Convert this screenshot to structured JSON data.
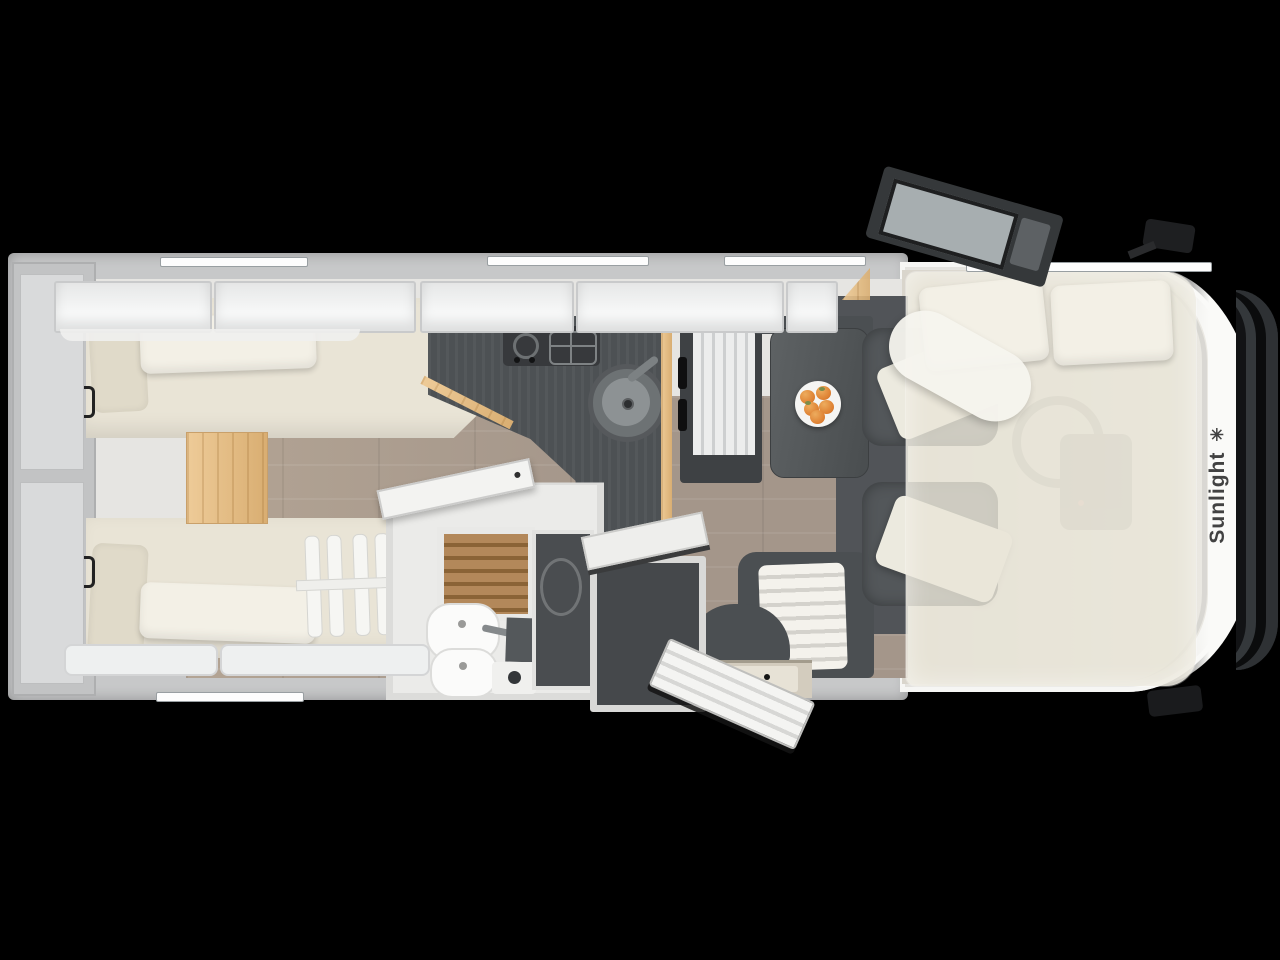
{
  "scene": {
    "type": "motorhome-floorplan-top-view",
    "description": "Top-down cutaway floor plan render of a Sunlight motorhome on a black background",
    "background_color": "#000000"
  },
  "branding": {
    "logo_text": "Sunlight",
    "logo_star_icon": "✳"
  },
  "palette": {
    "wall": "#c7c8c9",
    "cabinet_white": "#f3f4f4",
    "mattress_cream": "#e9e4d6",
    "pillow": "#f3f0e6",
    "floor_wood": "#a4968a",
    "oak_wood": "#e2bd8d",
    "counter_dark": "#4d5154",
    "seat_dark": "#53575a",
    "teak_slats": "#a97f4f",
    "fruit_orange": "#e0893c",
    "grille_black": "#121315",
    "drop_down_bed_overlay": "rgba(233,229,216,0.82)"
  },
  "zones": [
    "rear twin single beds with pillows and bed ladder",
    "oak step cabinet between beds",
    "rear garage storage",
    "kitchen with two-burner hob and round sink",
    "fridge with two black handles",
    "bathroom with teak shower grate and washbasin",
    "dark wardrobes",
    "dinette table with fruit plate and striped bench",
    "open entry door with step",
    "two swivel cab seats with white covers",
    "semi-transparent drop-down bed over cab with two pillows and duvet roll",
    "cockpit with faint steering wheel and dashboard",
    "open driver door, wing mirrors, front grille"
  ],
  "dinette": {
    "fruit_plate_fruit_count": 5
  }
}
